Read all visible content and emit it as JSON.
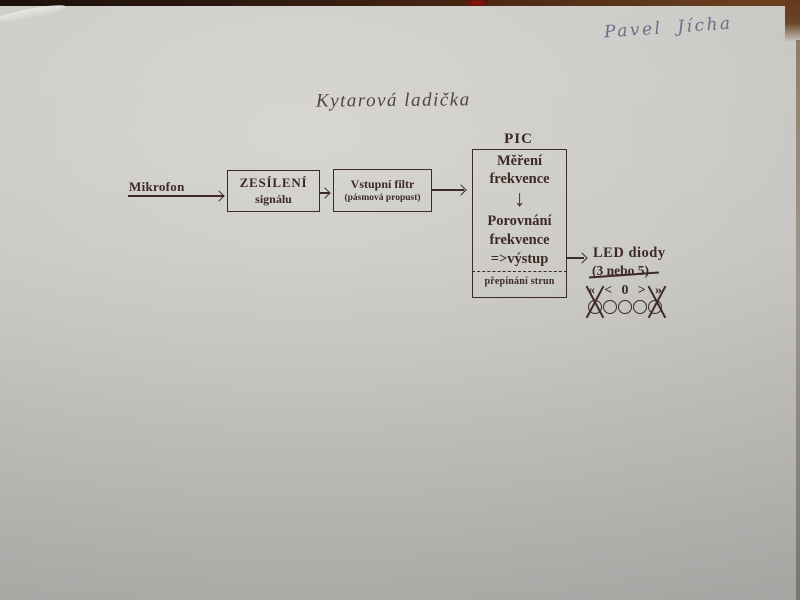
{
  "colors": {
    "paper": "#c8c7c3",
    "ink": "#3e2a24",
    "handwriting": "#5c627b",
    "table-brown": "#5e3318",
    "table-dark": "#1d110b",
    "red-mark": "#7c170c"
  },
  "annotations": {
    "handwritten_name": "Pavel Jícha"
  },
  "title": "Kytarová ladička",
  "diagram": {
    "microphone_label": "Mikrofon",
    "amplifier_box": {
      "line1": "ZESÍLENÍ",
      "line2": "signálu"
    },
    "filter_box": {
      "line1": "Vstupní filtr",
      "line2": "(pásmová propust)"
    },
    "pic": {
      "label": "PIC",
      "step1": {
        "line1": "Měření",
        "line2": "frekvence"
      },
      "flow_arrow": "↓",
      "step2": {
        "line1": "Porovnání",
        "line2": "frekvence",
        "line3": "=>výstup"
      },
      "footer": "přepínání strun"
    },
    "led": {
      "title": "LED diody",
      "count_note": "(3 nebo 5)",
      "symbols": [
        "«",
        "<",
        "0",
        ">",
        "»"
      ],
      "circle_count": "5"
    }
  }
}
